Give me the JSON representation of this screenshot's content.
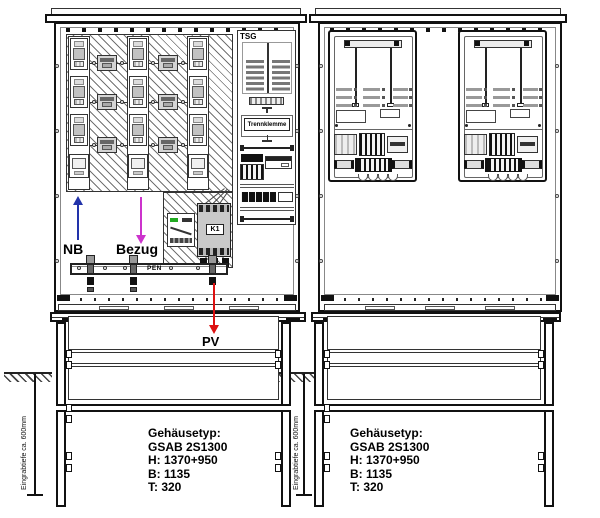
{
  "left_cabinet": {
    "tsg_label": "TSG",
    "trennklemme_label": "Trennklemme",
    "contactor_label": "K1",
    "pen_label": "PEN"
  },
  "flow_arrows": [
    {
      "label": "NB",
      "direction": "up",
      "color": "#2233aa"
    },
    {
      "label": "Bezug",
      "direction": "down",
      "color": "#cc33cc"
    },
    {
      "label": "PV",
      "direction": "down",
      "color": "#dd1111"
    }
  ],
  "depth_notes": {
    "left": "Eingrabtiefe ca. 600mm",
    "middle": "Eingrabtiefe ca. 600mm"
  },
  "enclosure_info_left": {
    "lines": [
      "Gehäusetyp:",
      "GSAB 2S1300",
      "H: 1370+950",
      "B: 1135",
      "T: 320"
    ]
  },
  "enclosure_info_right": {
    "lines": [
      "Gehäusetyp:",
      "GSAB 2S1300",
      "H: 1370+950",
      "B: 1135",
      "T: 320"
    ]
  },
  "colors": {
    "line": "#111111",
    "nb_arrow": "#2233aa",
    "bezug_arrow": "#cc33cc",
    "pv_line": "#dd1111",
    "gray_fill": "#c9c9c9"
  }
}
